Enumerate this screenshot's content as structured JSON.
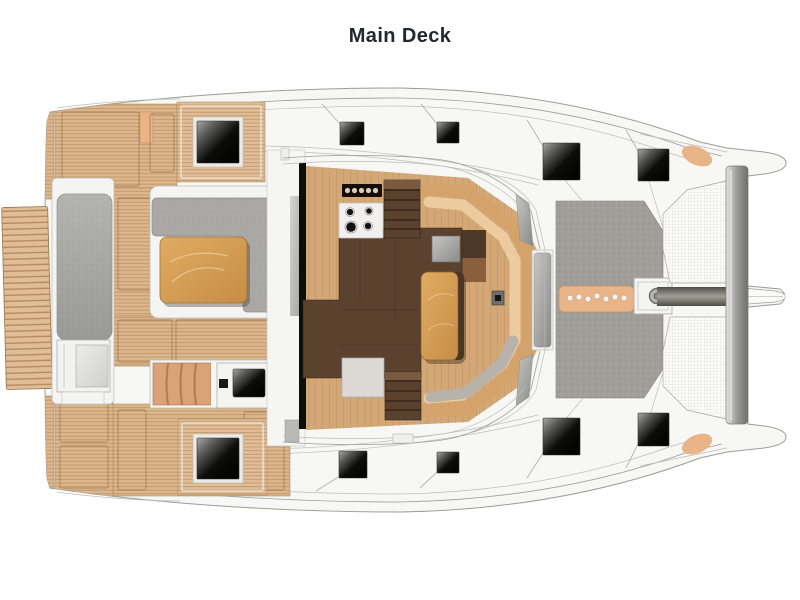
{
  "title": "Main Deck",
  "palette": {
    "background": "#ffffff",
    "title_color": "#23272f",
    "hull_fill": "#f7f7f5",
    "hull_line": "#9c9c9a",
    "teak_base": "#dcb68c",
    "teak_line": "#bd9266",
    "teak_edge": "#a8835c",
    "floor_wood": "#d4a876",
    "plank_line": "#ba8e5f",
    "walnut": "#5a422f",
    "walnut_dark": "#32251a",
    "oak": "#d7a057",
    "oak_dark": "#8a6233",
    "bench_wood": "#d4a26b",
    "bench_tan": "#eccb9f",
    "cushion_gray": "#b7b2aa",
    "sofa_gray": "#a9a8a4",
    "pad_gray": "#a09e99",
    "salmon": "#e9b588",
    "salmon_dark": "#c98f63",
    "window_gray": "#9f9f9d",
    "mesh_line": "#cbcbc9",
    "hatch_black": "#0a0a0a",
    "white_trim": "#f4f4f2"
  },
  "details": {
    "deck_hatch_count": 8,
    "stove_burner_count": 4,
    "stove_knob_count": 5,
    "anchor_step_hole_count": 7
  },
  "regions": [
    "swim-platform",
    "aft-bench",
    "cockpit-teak-deck",
    "cockpit-sofa",
    "cockpit-table",
    "cockpit-steps",
    "wet-bar-console",
    "sliding-door",
    "galley",
    "stove",
    "salon-stairs-starboard",
    "salon-stairs-port",
    "dinette-seating",
    "salon-table",
    "windshield",
    "foredeck-sunpad",
    "anchor-locker-step",
    "windlass",
    "bowsprit",
    "forward-crossbeam",
    "trampoline",
    "deck-hatches"
  ]
}
